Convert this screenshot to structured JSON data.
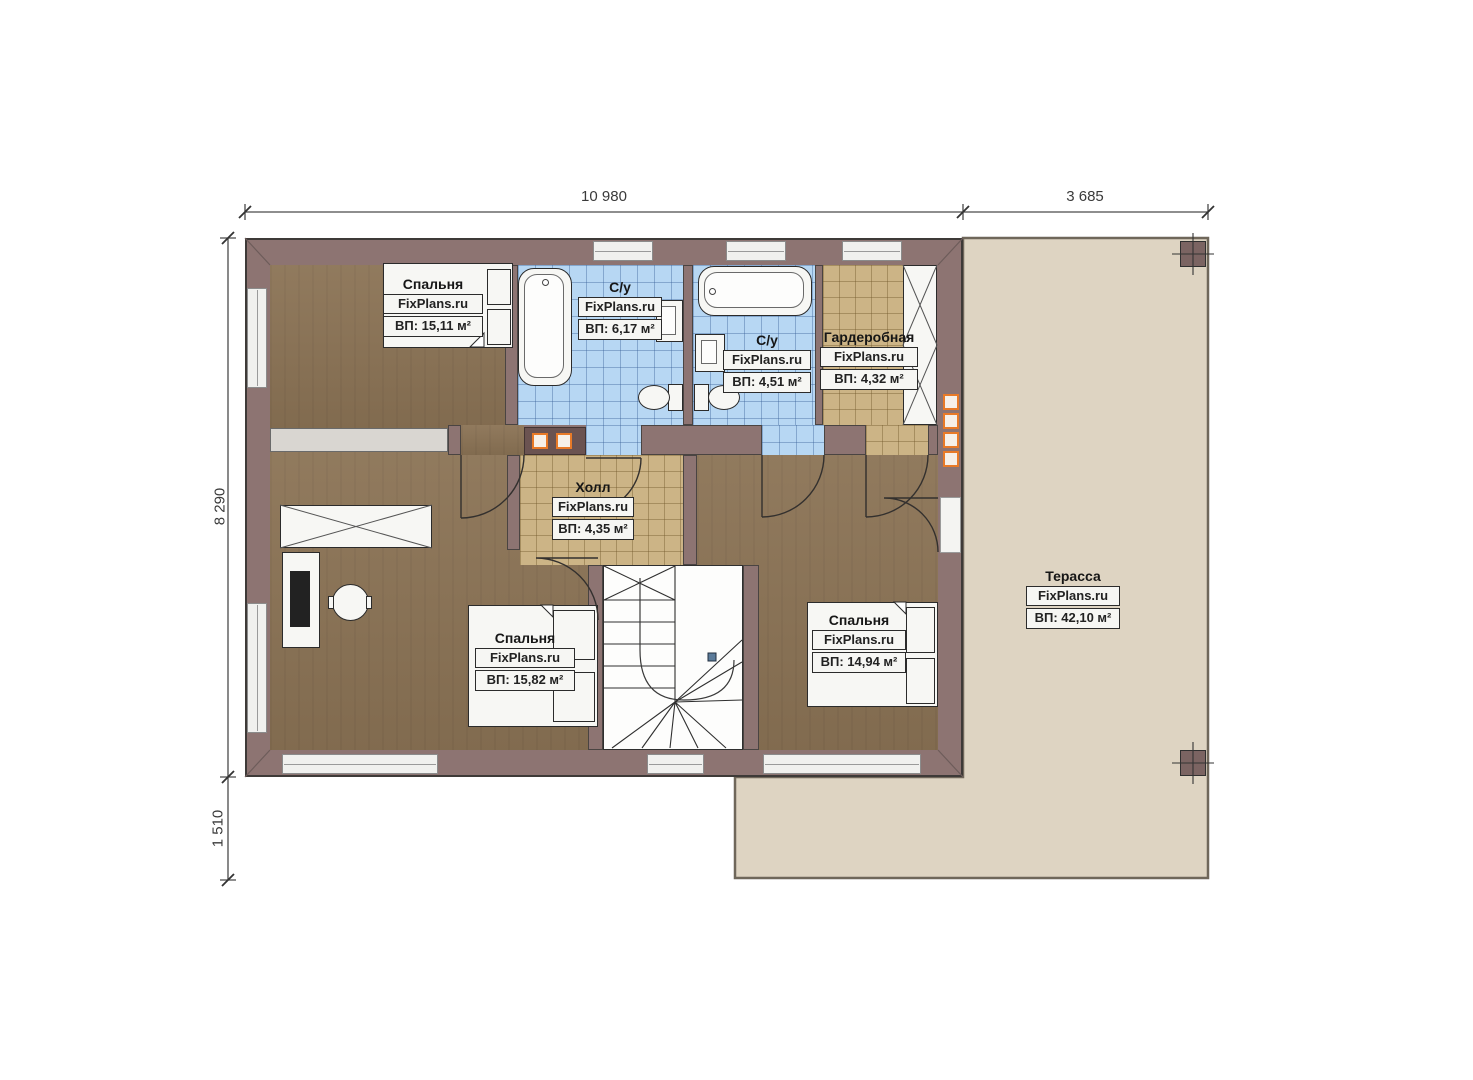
{
  "plan": {
    "brand": "FixPlans.ru",
    "dimensions": {
      "top_main": "10 980",
      "top_terrace": "3 685",
      "left_main": "8 290",
      "left_lower": "1 510"
    },
    "rooms": [
      {
        "key": "bedroom-top-left",
        "name": "Спальня",
        "brand": "FixPlans.ru",
        "area": "ВП: 15,11 м²"
      },
      {
        "key": "bathroom-large",
        "name": "С/у",
        "brand": "FixPlans.ru",
        "area": "ВП: 6,17 м²"
      },
      {
        "key": "bathroom-small",
        "name": "С/у",
        "brand": "FixPlans.ru",
        "area": "ВП: 4,51 м²"
      },
      {
        "key": "wardrobe",
        "name": "Гардеробная",
        "brand": "FixPlans.ru",
        "area": "ВП: 4,32 м²"
      },
      {
        "key": "hall",
        "name": "Холл",
        "brand": "FixPlans.ru",
        "area": "ВП: 4,35 м²"
      },
      {
        "key": "bedroom-bottom-left",
        "name": "Спальня",
        "brand": "FixPlans.ru",
        "area": "ВП: 15,82 м²"
      },
      {
        "key": "bedroom-bottom-right",
        "name": "Спальня",
        "brand": "FixPlans.ru",
        "area": "ВП: 14,94 м²"
      },
      {
        "key": "terrace",
        "name": "Терасса",
        "brand": "FixPlans.ru",
        "area": "ВП: 42,10 м²"
      }
    ],
    "colors": {
      "wall": "#8D7472",
      "wood_floor": "#8B7355",
      "tile_blue": "#B7D7F3",
      "tile_tan": "#CCB486",
      "terrace": "#DED4C2",
      "accent_orange": "#E87A28"
    }
  }
}
